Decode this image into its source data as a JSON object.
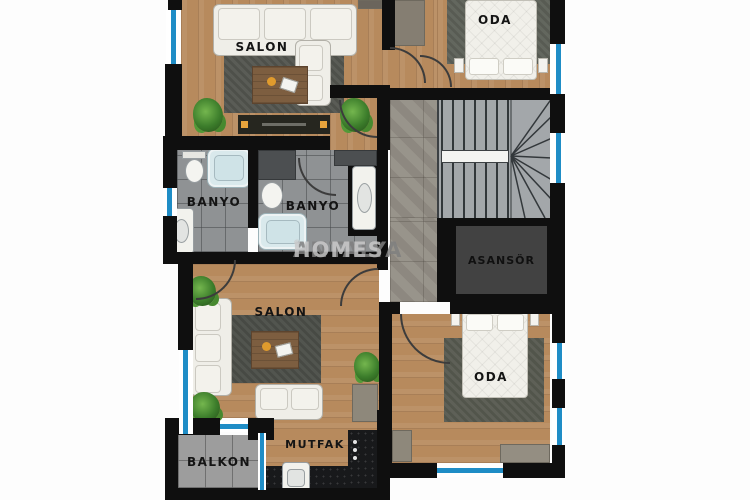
{
  "watermark": {
    "brand_bold": "ANTALYA",
    "brand_light": "HOMES",
    "registered": "®"
  },
  "rooms": {
    "salon_top": {
      "label": "SALON"
    },
    "oda_top": {
      "label": "ODA"
    },
    "banyo_left": {
      "label": "BANYO"
    },
    "banyo_right": {
      "label": "BANYO"
    },
    "salon_bottom": {
      "label": "SALON"
    },
    "oda_bottom": {
      "label": "ODA"
    },
    "mutfak": {
      "label": "MUTFAK"
    },
    "balkon": {
      "label": "BALKON"
    },
    "asansor": {
      "label": "ASANSÖR"
    }
  },
  "colors": {
    "wall": "#0f0f0f",
    "window_glass": "#1f8dc6",
    "wood_floor": "#b78a5d",
    "bath_tile": "#8f9294",
    "hall_tile": "#938e85",
    "balcony_tile": "#9d9d9d",
    "rug_dark": "#4e514b",
    "elevator_fill": "#424242",
    "counter_dark": "#18191b",
    "tub_blue": "#d9e9ec"
  }
}
